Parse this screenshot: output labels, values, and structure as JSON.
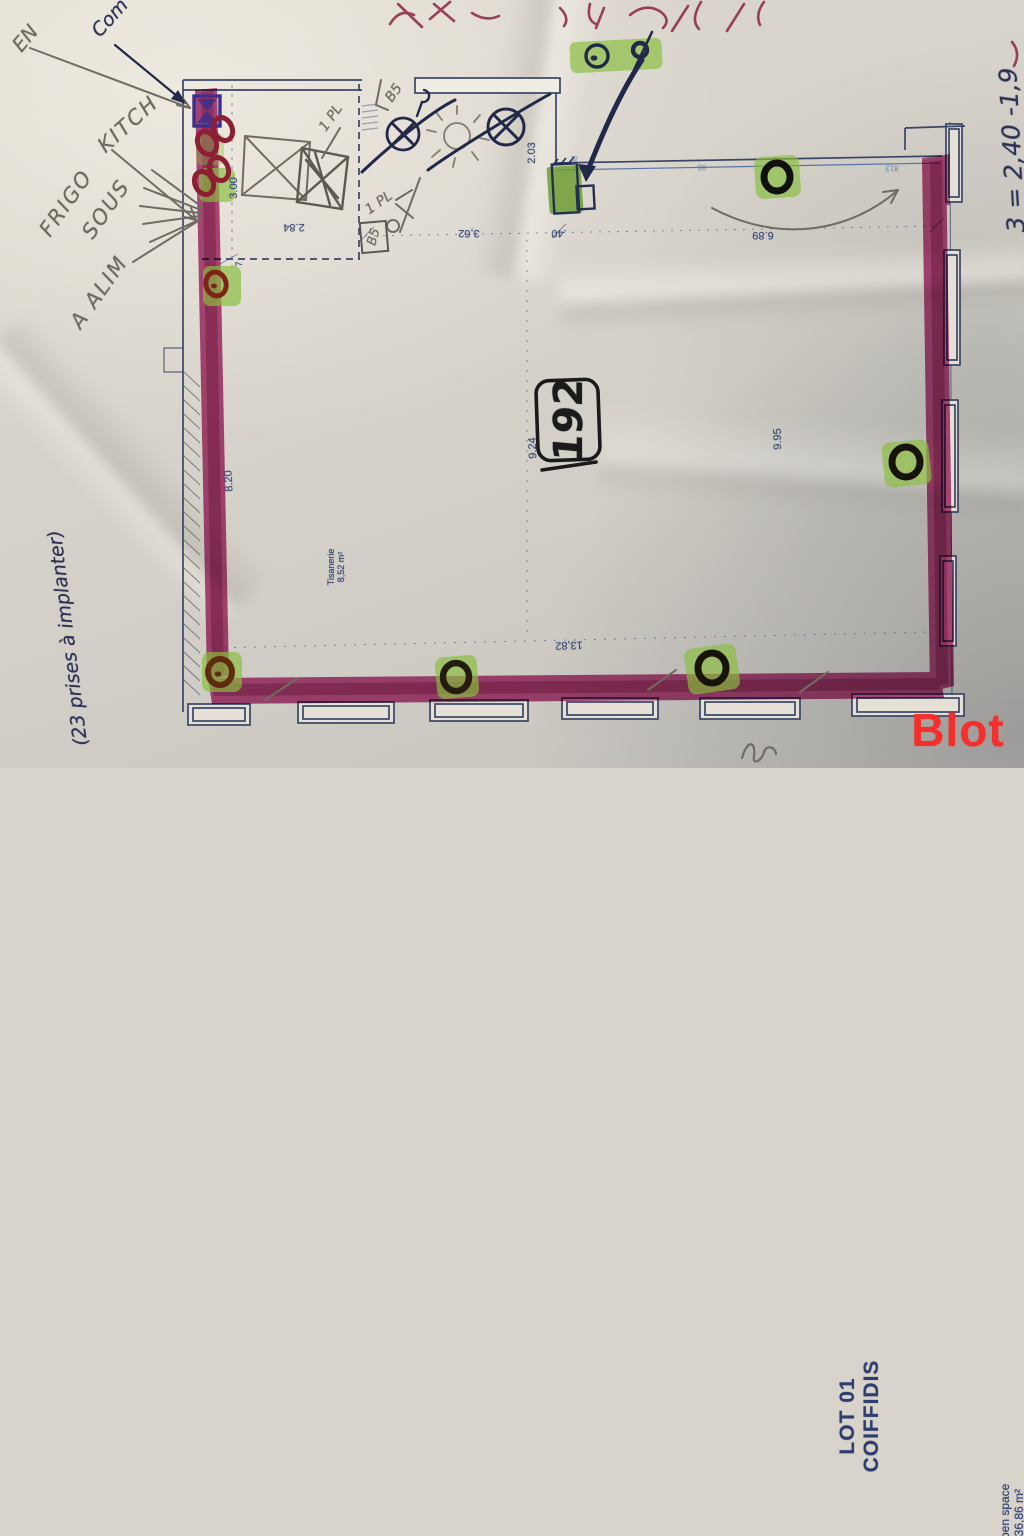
{
  "photo": {
    "logo_text": "Blot"
  },
  "plan_texts": {
    "lot_line1": "LOT 01",
    "lot_line2": "COIFFIDIS",
    "open_line1": "Open space",
    "open_line2": "136,86 m²",
    "tisanerie_line1": "Tisanerie",
    "tisanerie_line2": "8,52 m²"
  },
  "dims": [
    {
      "t": "3.00"
    },
    {
      "t": "2.84"
    },
    {
      "t": "3,62"
    },
    {
      "t": "2.03"
    },
    {
      "t": ".40"
    },
    {
      "t": "6.89"
    },
    {
      "t": "8.20"
    },
    {
      "t": "9.24"
    },
    {
      "t": "13,82"
    },
    {
      "t": "9.95"
    },
    {
      "t": "7"
    },
    {
      "t": "08"
    },
    {
      "t": "98"
    },
    {
      "t": "813"
    }
  ],
  "handwriting": {
    "en": "EN",
    "com": "Com",
    "kitch": "KITCH",
    "frigo": "FRIGO",
    "sous": "SOUS",
    "alim": "A ALIM",
    "prises": "(23 prises à implanter)",
    "heights": "3 = 2,40 -1,9",
    "circled_number": "192",
    "b5_top": "B5",
    "b5_box": "B5",
    "pl_top": "1 PL",
    "pl_mid": "1 PL"
  },
  "colors": {
    "wall_highlight": "#a92068",
    "outlet_highlight": "#8abf3f",
    "blueprint": "#3a4565",
    "ink": "#222848",
    "pencil": "#716c61",
    "red_pen": "#8f2f4b",
    "logo_red": "#f5302c",
    "marker": "#171717"
  }
}
